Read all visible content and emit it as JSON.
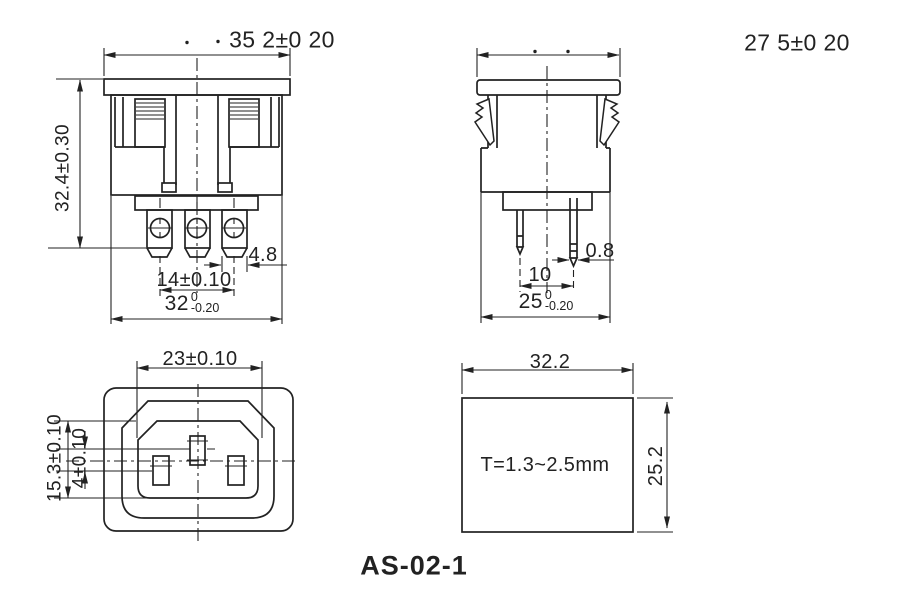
{
  "page": {
    "background": "#ffffff",
    "line_color": "#222222"
  },
  "title": "AS-02-1",
  "views": {
    "front": {
      "dims": {
        "flange_width": "35 2±0 20",
        "overall_height": "32.4±0.30",
        "terminal_width": "4.8",
        "terminal_spacing": "14±0.10",
        "body_width_value": "32",
        "body_width_tol_upper": "0",
        "body_width_tol_lower": "-0.20"
      }
    },
    "side": {
      "dims": {
        "flange_width": "27 5±0 20",
        "pin_thickness": "0.8",
        "pin_spacing": "10",
        "body_width_value": "25",
        "body_width_tol_upper": "0",
        "body_width_tol_lower": "-0.20"
      }
    },
    "face": {
      "dims": {
        "recess_width": "23±0.10",
        "recess_height": "15.3±0.10",
        "pin_offset": "4±0.10"
      }
    },
    "cutout": {
      "dims": {
        "width": "32.2",
        "height": "25.2",
        "panel_thickness": "T=1.3~2.5mm"
      }
    }
  }
}
